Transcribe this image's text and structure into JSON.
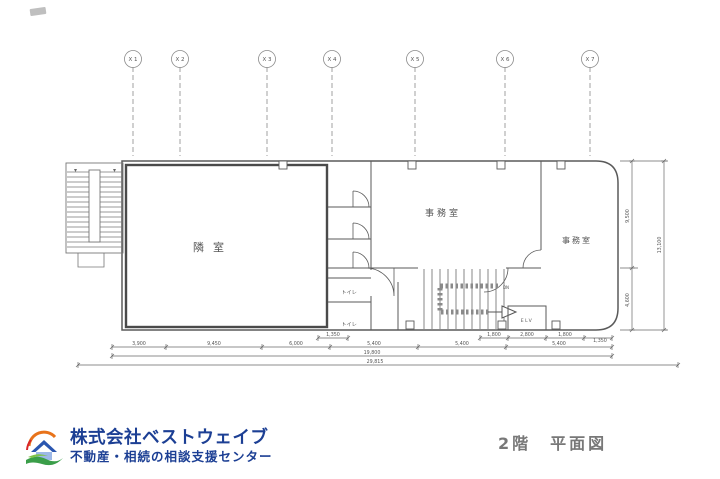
{
  "drawing": {
    "grid_axes": [
      "X 1",
      "X 2",
      "X 3",
      "X 4",
      "X 5",
      "X 6",
      "X 7"
    ],
    "rooms": {
      "adjacent_room": "隣室",
      "office_center": "事務室",
      "office_right": "事務室",
      "toilet_upper": "トイレ",
      "toilet_lower": "トイレ",
      "elevator": "ELV",
      "stair_note": "DN"
    },
    "dimensions": {
      "bottom_detail": [
        "1,350",
        "1,800",
        "2,800",
        "1,800",
        "1,350"
      ],
      "bottom_spans": [
        "3,900",
        "9,450",
        "6,000",
        "5,400",
        "5,400",
        "5,400"
      ],
      "bottom_subtotal": "19,800",
      "bottom_total": "29,815",
      "right_upper": "9,500",
      "right_lower": "4,600",
      "right_total": "13,100"
    }
  },
  "footer": {
    "company_name": "株式会社ベストウェイブ",
    "company_tagline": "不動産・相続の相談支援センター",
    "plan_title": "2階　平面図"
  },
  "colors": {
    "line": "#5a5a5a",
    "dim_text": "#555555",
    "brand_blue": "#1c3f94",
    "logo_green": "#3a9e49",
    "logo_orange": "#e8731a",
    "logo_red": "#d8262b",
    "title_gray": "#787878"
  }
}
